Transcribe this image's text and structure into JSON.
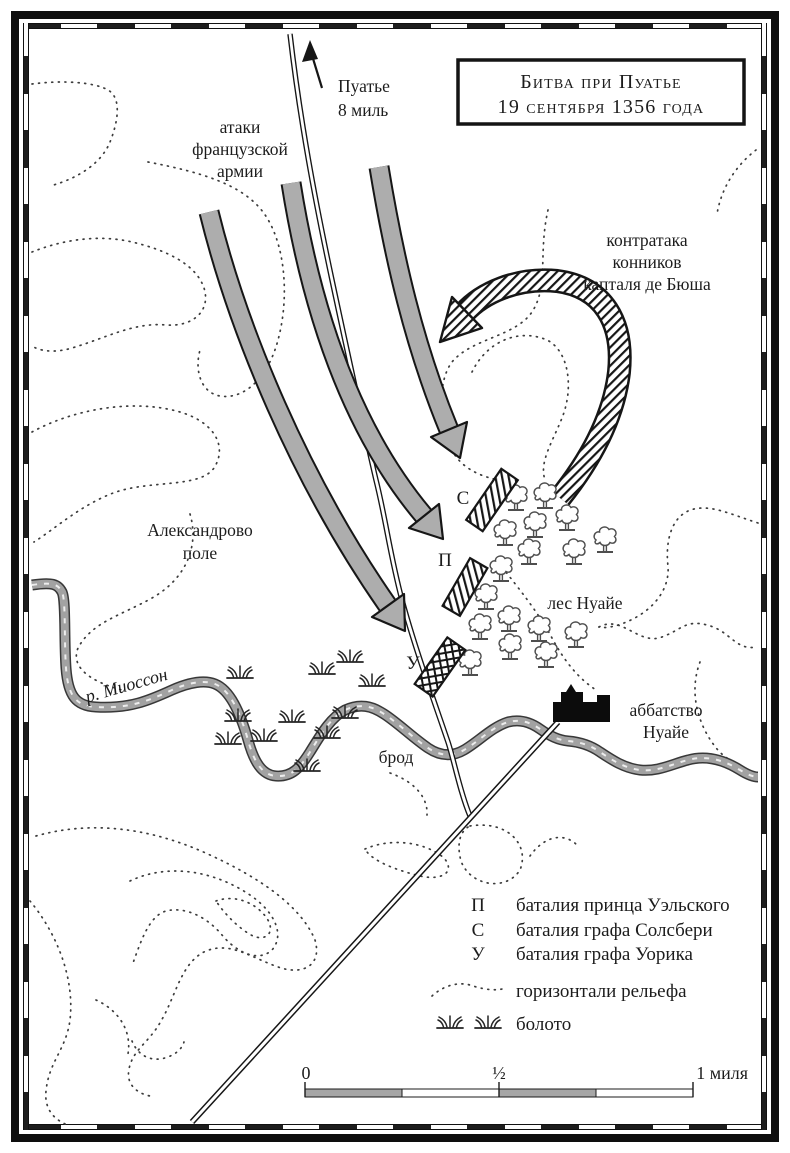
{
  "title_box": {
    "line1": "Битва при Пуатье",
    "line2": "19 сентября 1356 года"
  },
  "labels": {
    "road_north": {
      "line1": "Пуатье",
      "line2": "8 миль"
    },
    "french_attacks": {
      "line1": "атаки",
      "line2": "французской",
      "line3": "армии"
    },
    "counterattack": {
      "line1": "контратака",
      "line2": "конников",
      "line3": "капталя де Бюша"
    },
    "alexander_field": {
      "line1": "Александрово",
      "line2": "поле"
    },
    "noailles_wood": "лес Нуайе",
    "river": "р. Миоссон",
    "ford": "брод",
    "abbey": {
      "line1": "аббатство",
      "line2": "Нуайе"
    },
    "unit_s": "С",
    "unit_p": "П",
    "unit_u": "У"
  },
  "legend": {
    "units": [
      {
        "symbol": "П",
        "label": "баталия принца Уэльского"
      },
      {
        "symbol": "С",
        "label": "баталия графа Солсбери"
      },
      {
        "symbol": "У",
        "label": "баталия графа Уорика"
      }
    ],
    "contours_label": "горизонтали рельефа",
    "marsh_label": "болото"
  },
  "scale_bar": {
    "start": "0",
    "middle": "½",
    "end": "1 миля"
  },
  "colors": {
    "ink": "#1a1a1a",
    "attack_arrow_gray": "#adadad",
    "river_gray": "#a2a2a2",
    "paper": "#ffffff"
  }
}
